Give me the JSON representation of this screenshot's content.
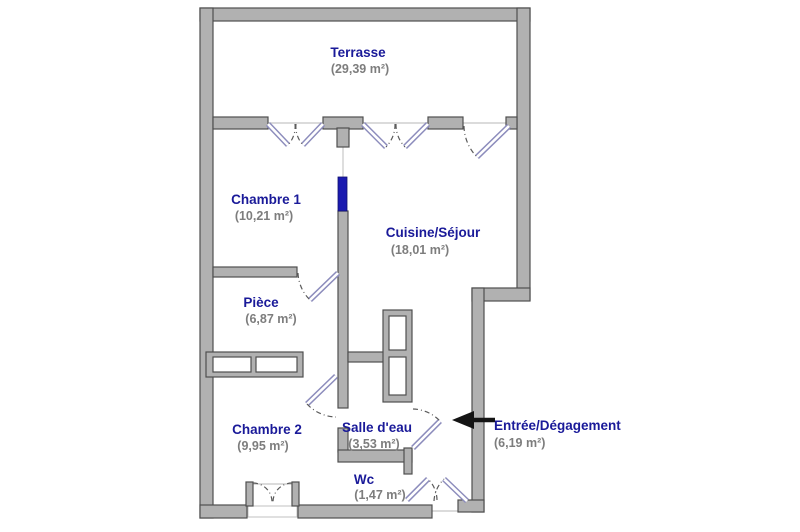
{
  "plan": {
    "title": "Floor plan",
    "colors": {
      "background": "#ffffff",
      "wall": "#b1b1b1",
      "wall_stroke": "#4f4f4f",
      "room_label": "#1a1a99",
      "area_label": "#7d7d7d",
      "door": "#8c8cbc",
      "sliding_door": "#1a1ab0",
      "arrow": "#141414"
    },
    "rooms": {
      "terrasse": {
        "name": "Terrasse",
        "area": "(29,39 m²)"
      },
      "chambre1": {
        "name": "Chambre 1",
        "area": "(10,21 m²)"
      },
      "cuisine": {
        "name": "Cuisine/Séjour",
        "area": "(18,01 m²)"
      },
      "piece": {
        "name": "Pièce",
        "area": "(6,87 m²)"
      },
      "chambre2": {
        "name": "Chambre 2",
        "area": "(9,95 m²)"
      },
      "salle_deau": {
        "name": "Salle d'eau",
        "area": "(3,53 m²)"
      },
      "wc": {
        "name": "Wc",
        "area": "(1,47 m²)"
      },
      "entree": {
        "name": "Entrée/Dégagement",
        "area": "(6,19 m²)"
      }
    }
  }
}
